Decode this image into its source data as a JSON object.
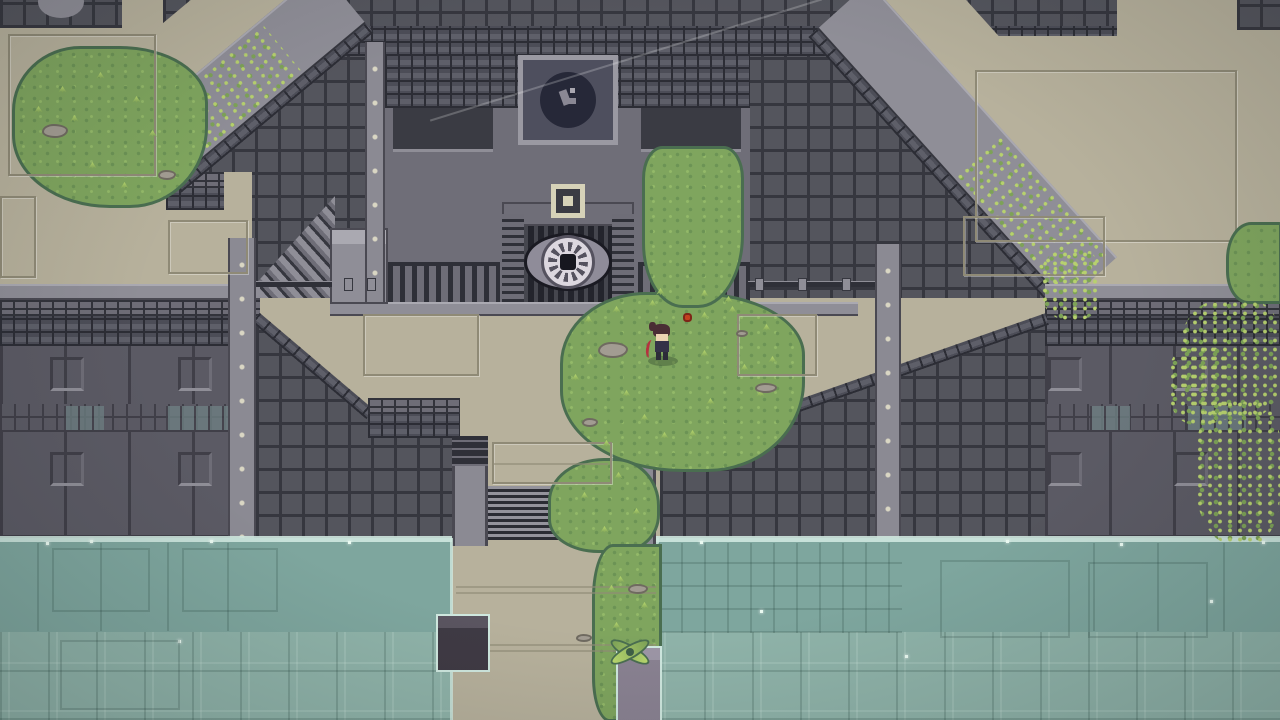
{
  "scene": {
    "name": "pixel-temple-courtyard",
    "description": "Top-down pixel-art temple with eye-emblem gate, stone walls, overgrown grass, central stairs descending to a flooded moat",
    "no_visible_text": true
  },
  "palette": {
    "beige": "#b7b19c",
    "beigeLine": "#8f8a76",
    "grid": "#54555d",
    "gridLine": "#36373f",
    "frameBg": "#4c4d57",
    "frameLine": "#2c2d35",
    "frameLight": "#5e5f69",
    "panel": "#5b5a64",
    "panelLine": "#403f48",
    "greekBg": "#6e6d77",
    "greekLine": "#32333b",
    "ledge": "#8f8e97",
    "ledgeHi": "#aaa9b1",
    "ledgeLo": "#4a4952",
    "strip": "#8b8a93",
    "stripDot": "#d9d6c3",
    "temple": "#6f6e78",
    "niche": "#3a3b43",
    "gate": "#23242c",
    "gateBar": "#2f3038",
    "gateBarHi": "#45464e",
    "plaqueRim": "#9a99a2",
    "plaqueBg": "#4e4f5e",
    "plaqueCircle": "#262838",
    "plaqueGlyph": "#8a8894",
    "emblemBeige": "#d6d2b8",
    "eyeLid": "#8f8c99",
    "eyeOutline": "#1a1a22",
    "eyeSclera": "#dcd7df",
    "eyeSpoke": "#55525f",
    "eyePupil": "#17171f",
    "grass": "#7fa55e",
    "grassDark": "#6c9355",
    "grassLight": "#93b968",
    "grassEdge": "#4a6e50",
    "tuftLight": "#b9d86e",
    "vineLight": "#b7d16e",
    "vineMid": "#7da257",
    "water": "#7ea69e",
    "waterLow": "#8fb3a9",
    "waterLine": "#cfe8df",
    "waterGrid": "rgba(25,55,48,0.18)",
    "waterGridHi": "rgba(225,245,236,0.15)",
    "sparkle": "#eafaf1",
    "stone": "#a29c92",
    "stoneEdge": "#6f6a60",
    "stairsDark": "#2b2c34",
    "stairsLight": "#94939c",
    "windowTile": "#6e7f82",
    "heroHair": "#4a2e35",
    "heroSkin": "#ecd3b2",
    "heroShirt": "#343147",
    "heroRed": "#b5333f",
    "heroLegs": "#2c2b38",
    "flowerRed": "#c2401f",
    "flowerEdge": "#7e2517",
    "shadow": "rgba(40,60,40,0.35)"
  },
  "entities": {
    "hero": {
      "x": 646,
      "y": 320,
      "w": 34,
      "h": 48,
      "facing": "left",
      "holding": "red-bow"
    },
    "flower": {
      "x": 683,
      "y": 313,
      "w": 9,
      "h": 9
    },
    "xplant": {
      "x": 608,
      "y": 632,
      "w": 44,
      "h": 40
    },
    "eye_door": {
      "cx": 568,
      "cy": 262,
      "w": 88,
      "h": 58
    },
    "plaque": {
      "x": 518,
      "y": 55,
      "w": 100,
      "h": 90
    },
    "stairs": {
      "x": 488,
      "y": 486,
      "w": 132,
      "h": 54,
      "step_count": 9
    },
    "waterline_y": 536
  },
  "decor": [
    {
      "t": "ffr",
      "x": 363,
      "y": 314,
      "w": 116,
      "h": 62
    },
    {
      "t": "ffr",
      "x": 737,
      "y": 314,
      "w": 80,
      "h": 62
    },
    {
      "t": "ffr",
      "x": 975,
      "y": 70,
      "w": 262,
      "h": 172
    },
    {
      "t": "ffr",
      "x": 168,
      "y": 220,
      "w": 80,
      "h": 54
    },
    {
      "t": "ffr",
      "x": 963,
      "y": 216,
      "w": 142,
      "h": 60
    },
    {
      "t": "ffr",
      "x": 492,
      "y": 442,
      "w": 120,
      "h": 42
    },
    {
      "t": "ffr",
      "x": 8,
      "y": 34,
      "w": 148,
      "h": 142
    },
    {
      "t": "ffr",
      "x": 0,
      "y": 196,
      "w": 36,
      "h": 82
    },
    {
      "t": "seam",
      "x": 456,
      "y": 586,
      "w": 200
    },
    {
      "t": "seam",
      "x": 456,
      "y": 592,
      "w": 200
    },
    {
      "t": "seam",
      "x": 456,
      "y": 644,
      "w": 200
    },
    {
      "t": "seam",
      "x": 456,
      "y": 650,
      "w": 200
    },
    {
      "t": "seam",
      "x": 494,
      "y": 463,
      "w": 114
    },
    {
      "t": "wsq",
      "x": 50,
      "y": 357
    },
    {
      "t": "wsq",
      "x": 178,
      "y": 357
    },
    {
      "t": "wsq",
      "x": 50,
      "y": 452
    },
    {
      "t": "wsq",
      "x": 178,
      "y": 452
    },
    {
      "t": "wsq",
      "x": 1048,
      "y": 357
    },
    {
      "t": "wsq",
      "x": 1174,
      "y": 357
    },
    {
      "t": "wsq",
      "x": 1048,
      "y": 452
    },
    {
      "t": "wsq",
      "x": 1174,
      "y": 452
    },
    {
      "t": "lcl",
      "x": 64,
      "y": 406,
      "w": 40,
      "h": 24
    },
    {
      "t": "lcl",
      "x": 166,
      "y": 406,
      "w": 62,
      "h": 24
    },
    {
      "t": "lcl",
      "x": 1090,
      "y": 406,
      "w": 40,
      "h": 24
    },
    {
      "t": "lcl",
      "x": 1186,
      "y": 406,
      "w": 60,
      "h": 24
    },
    {
      "t": "fit",
      "x": 344,
      "y": 278
    },
    {
      "t": "fit",
      "x": 367,
      "y": 278
    },
    {
      "t": "fit",
      "x": 755,
      "y": 278
    },
    {
      "t": "fit",
      "x": 798,
      "y": 278
    },
    {
      "t": "fit",
      "x": 842,
      "y": 278
    },
    {
      "t": "tuft",
      "x": 584,
      "y": 316
    },
    {
      "t": "tuft",
      "x": 612,
      "y": 306
    },
    {
      "t": "tuft",
      "x": 648,
      "y": 300
    },
    {
      "t": "tuft",
      "x": 700,
      "y": 312
    },
    {
      "t": "tuft",
      "x": 728,
      "y": 306
    },
    {
      "t": "tuft",
      "x": 762,
      "y": 324
    },
    {
      "t": "tuft",
      "x": 700,
      "y": 350
    },
    {
      "t": "tuft",
      "x": 740,
      "y": 364
    },
    {
      "t": "tuft",
      "x": 768,
      "y": 356
    },
    {
      "t": "tuft",
      "x": 622,
      "y": 390
    },
    {
      "t": "tuft",
      "x": 640,
      "y": 414
    },
    {
      "t": "tuft",
      "x": 602,
      "y": 440
    },
    {
      "t": "tuft",
      "x": 660,
      "y": 432
    },
    {
      "t": "tuft",
      "x": 706,
      "y": 398
    },
    {
      "t": "tuft",
      "x": 586,
      "y": 354
    },
    {
      "t": "tuft",
      "x": 571,
      "y": 374
    },
    {
      "t": "tuft",
      "x": 756,
      "y": 390
    },
    {
      "t": "tuft",
      "x": 688,
      "y": 430
    },
    {
      "t": "tuft",
      "x": 58,
      "y": 86
    },
    {
      "t": "tuft",
      "x": 96,
      "y": 72
    },
    {
      "t": "tuft",
      "x": 132,
      "y": 96
    },
    {
      "t": "tuft",
      "x": 48,
      "y": 132
    },
    {
      "t": "tuft",
      "x": 148,
      "y": 130
    },
    {
      "t": "tuft",
      "x": 88,
      "y": 162
    },
    {
      "t": "tuft",
      "x": 120,
      "y": 182
    },
    {
      "t": "tuft",
      "x": 34,
      "y": 106
    },
    {
      "t": "tuft",
      "x": 70,
      "y": 115
    },
    {
      "t": "tuft",
      "x": 580,
      "y": 492
    },
    {
      "t": "tuft",
      "x": 614,
      "y": 472
    },
    {
      "t": "tuft",
      "x": 600,
      "y": 526
    },
    {
      "t": "tuft",
      "x": 632,
      "y": 508
    },
    {
      "t": "tuft",
      "x": 616,
      "y": 576
    },
    {
      "t": "tuft",
      "x": 640,
      "y": 602
    },
    {
      "t": "tuft",
      "x": 612,
      "y": 622
    },
    {
      "t": "tuft",
      "x": 636,
      "y": 692
    },
    {
      "t": "tuft",
      "x": 618,
      "y": 662
    },
    {
      "t": "tuft",
      "x": 607,
      "y": 585
    },
    {
      "t": "tuft",
      "x": 656,
      "y": 288
    },
    {
      "t": "tuft",
      "x": 700,
      "y": 290
    },
    {
      "t": "tuft",
      "x": 724,
      "y": 296
    },
    {
      "t": "tuft",
      "x": 1242,
      "y": 248
    },
    {
      "t": "tuft",
      "x": 1262,
      "y": 272
    },
    {
      "t": "stone",
      "x": 598,
      "y": 342,
      "w": 30,
      "h": 16
    },
    {
      "t": "stone",
      "x": 755,
      "y": 383,
      "w": 22,
      "h": 10
    },
    {
      "t": "stone",
      "x": 42,
      "y": 124,
      "w": 26,
      "h": 14
    },
    {
      "t": "stone",
      "x": 158,
      "y": 170,
      "w": 18,
      "h": 10
    },
    {
      "t": "stone",
      "x": 582,
      "y": 418,
      "w": 16,
      "h": 9
    },
    {
      "t": "stone",
      "x": 628,
      "y": 584,
      "w": 20,
      "h": 10
    },
    {
      "t": "stone",
      "x": 576,
      "y": 634,
      "w": 16,
      "h": 8
    },
    {
      "t": "stone",
      "x": 736,
      "y": 330,
      "w": 12,
      "h": 7
    },
    {
      "t": "sparkle",
      "x": 210,
      "y": 540
    },
    {
      "t": "sparkle",
      "x": 348,
      "y": 541
    },
    {
      "t": "sparkle",
      "x": 46,
      "y": 542
    },
    {
      "t": "sparkle",
      "x": 700,
      "y": 541
    },
    {
      "t": "sparkle",
      "x": 905,
      "y": 655
    },
    {
      "t": "sparkle",
      "x": 1006,
      "y": 540
    },
    {
      "t": "sparkle",
      "x": 1120,
      "y": 543
    },
    {
      "t": "sparkle",
      "x": 1210,
      "y": 600
    },
    {
      "t": "sparkle",
      "x": 178,
      "y": 640
    },
    {
      "t": "sparkle",
      "x": 760,
      "y": 610
    },
    {
      "t": "sparkle",
      "x": 1262,
      "y": 541
    },
    {
      "t": "sparkle",
      "x": 90,
      "y": 540
    },
    {
      "t": "wfr",
      "x": 52,
      "y": 548,
      "w": 98,
      "h": 64
    },
    {
      "t": "wfr",
      "x": 182,
      "y": 548,
      "w": 96,
      "h": 64
    },
    {
      "t": "wfr",
      "x": 940,
      "y": 560,
      "w": 130,
      "h": 78
    },
    {
      "t": "wfr",
      "x": 1088,
      "y": 562,
      "w": 120,
      "h": 76
    },
    {
      "t": "wfr",
      "x": 60,
      "y": 640,
      "w": 120,
      "h": 70
    },
    {
      "t": "wseam",
      "x": 37,
      "y": 543
    },
    {
      "t": "wseam",
      "x": 100,
      "y": 543
    },
    {
      "t": "wseam",
      "x": 167,
      "y": 543
    },
    {
      "t": "wseam",
      "x": 227,
      "y": 543
    },
    {
      "t": "wseam",
      "x": 1093,
      "y": 543
    },
    {
      "t": "wseam",
      "x": 1157,
      "y": 543
    },
    {
      "t": "wseam",
      "x": 1223,
      "y": 543
    },
    {
      "t": "gblob",
      "x": 1226,
      "y": 222,
      "w": 56,
      "h": 82
    },
    {
      "t": "vpatch",
      "x": 1180,
      "y": 300,
      "w": 100,
      "h": 120
    },
    {
      "t": "vpatch",
      "x": 1195,
      "y": 400,
      "w": 85,
      "h": 145
    },
    {
      "t": "vpatch",
      "x": 1168,
      "y": 345,
      "w": 60,
      "h": 80
    },
    {
      "t": "vpatch",
      "x": 1040,
      "y": 250,
      "w": 60,
      "h": 70
    }
  ]
}
